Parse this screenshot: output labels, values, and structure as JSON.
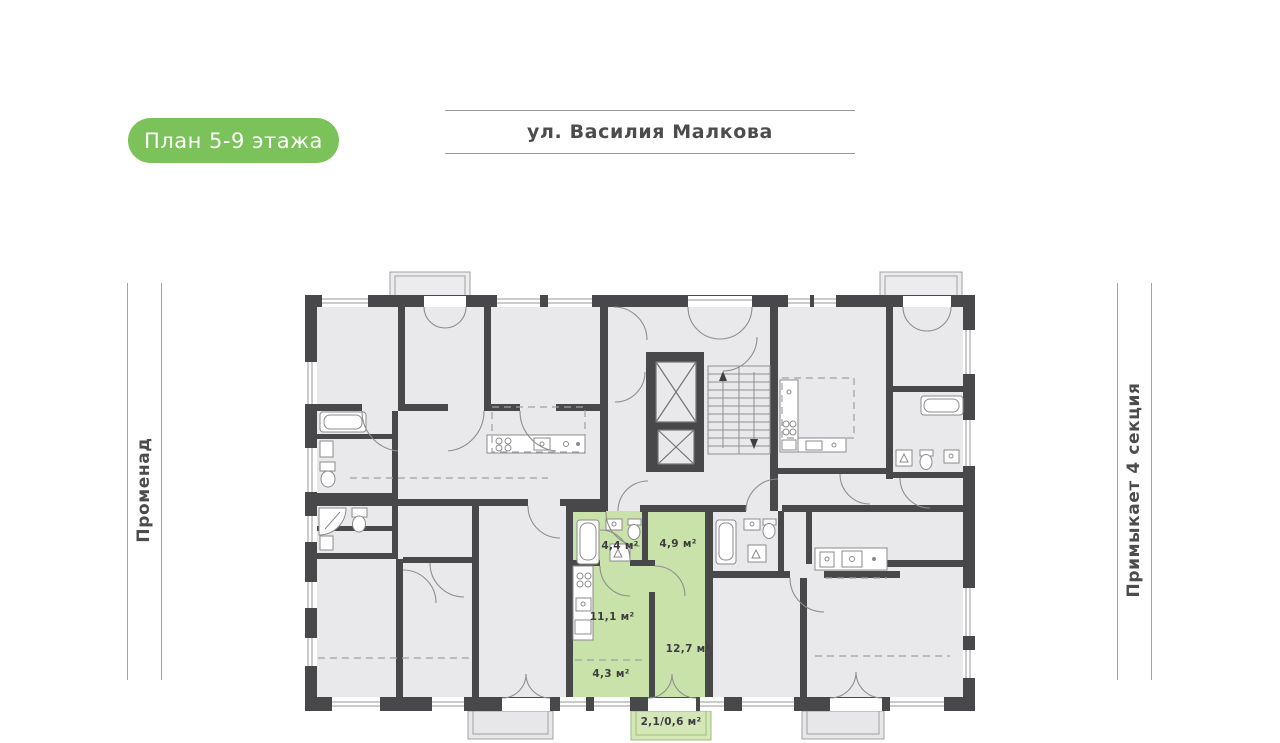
{
  "badge": {
    "label": "План 5-9 этажа"
  },
  "header": {
    "street": "ул. Василия Малкова"
  },
  "side_labels": {
    "left": "Променад",
    "right": "Примыкает 4 секция"
  },
  "plan": {
    "rooms": [
      {
        "id": "area-1",
        "area": "4,4 м²"
      },
      {
        "id": "area-2",
        "area": "4,9 м²"
      },
      {
        "id": "area-3",
        "area": "11,1 м²"
      },
      {
        "id": "area-4",
        "area": "12,7 м²"
      },
      {
        "id": "area-5",
        "area": "4,3 м²"
      },
      {
        "id": "area-6",
        "area": "2,1/0,6 м²"
      }
    ]
  },
  "colors": {
    "accent_green": "#7cc25a",
    "apartment_highlight": "#c9e2aa",
    "balcony_highlight": "#d3e7b8",
    "wall": "#48484a",
    "room_fill": "#e9e9eb",
    "thin_line": "#97979a"
  },
  "icons": {
    "elevator": "crossed-box",
    "stairs": "treads-with-direction-arrows",
    "door": "quarter-arc",
    "window": "double-line-slot",
    "bathtub": "rounded-rect",
    "stove": "four-burner-circles",
    "sink": "square-with-dot"
  }
}
